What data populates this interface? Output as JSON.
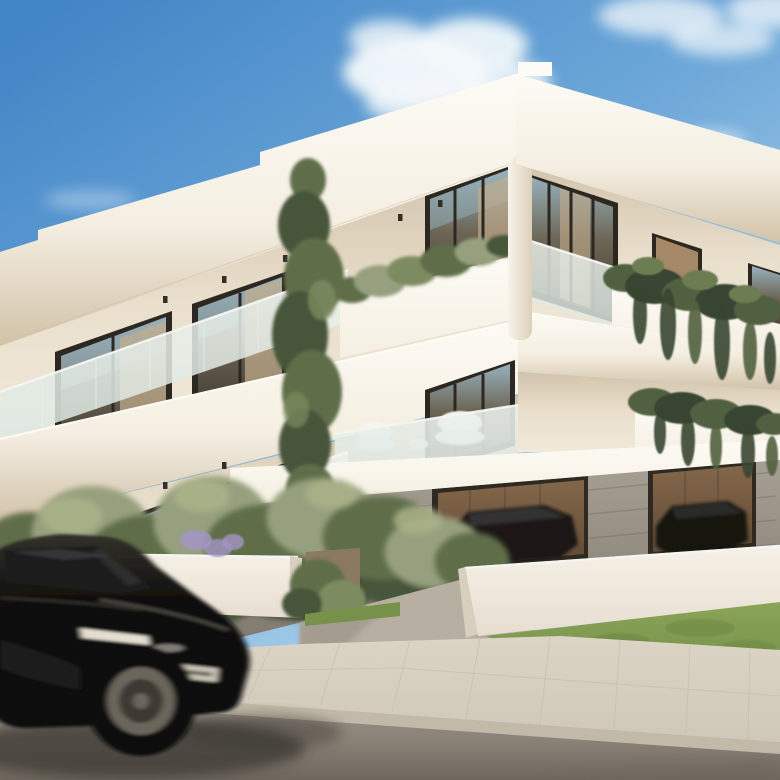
{
  "scene": {
    "type": "photorealistic architectural exterior rendering",
    "subject": "modern two-storey white apartment building with ground-level pilotis parking",
    "setting": "sunny day, clear blue sky with scattered clouds, street with sidewalk in foreground",
    "foreground": "black SUV driving left-to-right with motion blur on asphalt road",
    "landscaping": "olive trees and shrubs behind low white garden walls, lavender accents, lawn at right",
    "building_features": "flat roof slabs, recessed balconies with frosted glass balustrades, dark-framed floor-to-ceiling windows, white planter parapets with trailing ivy, board-formed concrete garage with timber back wall, parked cars under building",
    "elements": {
      "sky": "gradient blue sky",
      "clouds": "soft white cumulus wisps",
      "roof": "stepped white roof slabs with parapet",
      "balcony": "recessed balcony with frosted glass balustrade",
      "garage": "open parking bays under building",
      "suv": "black luxury SUV, front three-quarter view, motion blurred",
      "license_plate": "illegible light grey plate",
      "road": "grey asphalt",
      "sidewalk": "light stone paved sidewalk with curb"
    }
  },
  "colors": {
    "sky_top": "#4285c6",
    "sky_mid": "#6ea8d9",
    "sky_low": "#a9cfe9",
    "sky_horizon": "#d3e6f3",
    "cloud_white": "#f5f9fb",
    "slab_top": "#fdfbf5",
    "slab_mid": "#f5efe2",
    "slab_warm": "#e6dac3",
    "soffit_deep": "#d2c2a8",
    "recess_top": "#d2c3ab",
    "recess_mid": "#e9dfcc",
    "recess_light": "#f1e9d9",
    "frame_dark": "#2c2720",
    "glass_top": "#96b1bc",
    "glass_mid": "#6d6656",
    "glass_dark": "#3e382e",
    "curtain": "#c4ae8d",
    "curtain_warm": "#b3946f",
    "frost": "#dde8e2",
    "frost_light": "#edf2ed",
    "column_light": "#f8f3e9",
    "column_shade": "#dcd0ba",
    "ivy_dark": "#384530",
    "ivy_mid": "#51613f",
    "ivy_light": "#6d7d52",
    "tree_dark": "#46553a",
    "tree_mid": "#5e6e48",
    "tree_light": "#7d8b60",
    "olive_gray": "#97a07e",
    "olive_light": "#aab188",
    "lavender": "#a495c6",
    "concrete_light": "#a8a196",
    "concrete_dark": "#827b70",
    "wood_light": "#84674a",
    "wood_dark": "#5e4935",
    "garage_dark": "#2e2921",
    "car_parked": "#1b1915",
    "car_parked2": "#141210",
    "fence_light": "#f6f1e7",
    "fence_shade": "#e7ded0",
    "fence_dark": "#d9cfbe",
    "grass_light": "#8aa458",
    "grass_mid": "#76924a",
    "grass_dark": "#5f7a3a",
    "pillar_stone": "#8b7961",
    "driveway": "#b6afa2",
    "driveway_shade": "#9f988b",
    "side_light": "#dcd4c5",
    "side_mid": "#cfc7b7",
    "curb": "#c2b9a8",
    "road_light": "#9b938a",
    "road_mid": "#8b8378",
    "road_dark": "#6e675e",
    "shadow": "#3a3732",
    "shadow_soft": "#55504a",
    "suv_body": "#0f0e0c",
    "suv_top": "#33312b",
    "suv_glass": "#1d1c1a",
    "suv_reflect": "#474950",
    "rim": "#6b665b",
    "hub": "#2c2a26",
    "plate": "#c8c3b4",
    "headlight": "#efeadb",
    "downlight": "#332e26",
    "white_chair": "#eef0ea",
    "cushion": "#f6f5ee"
  }
}
